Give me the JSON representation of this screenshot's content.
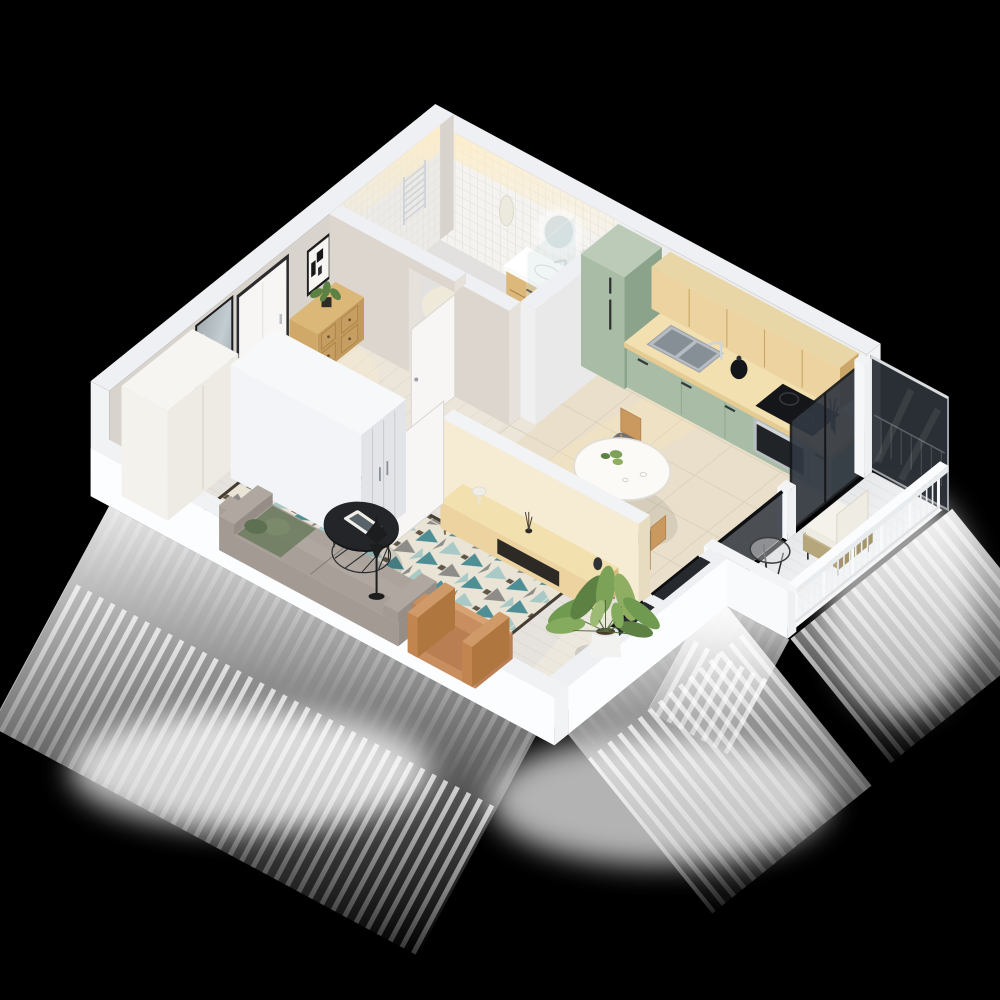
{
  "scene": {
    "description": "3D isometric cutaway floor-plan render of a studio apartment on a black background",
    "view": "top-down axonometric, no ceiling, exterior light-glow under the cut walls",
    "background": "#000000"
  },
  "palette": {
    "background": "#000000",
    "wallTop": "#eef0f3",
    "wallInnerWhite": "#ececea",
    "wallGreige": "#d8d3cc",
    "wallCream": "#f6ecd3",
    "wallCreamShade": "#e8dcc0",
    "wallOuterBright": "#fcfdfe",
    "floorWood": "#e6e3de",
    "floorHall": "#ebe5da",
    "floorKitchen": "#eadfcb",
    "floorBath": "#e2e1df",
    "tileWhite": "#f4f3f0",
    "tileLine": "#e2e0da",
    "cabinetGreen": "#a9bda6",
    "cabinetGreenDark": "#8ba38a",
    "woodLight": "#ecd3a0",
    "woodMid": "#d9ba7e",
    "counterTop": "#f2e0b0",
    "steel": "#b9bec2",
    "chrome": "#cfd4d9",
    "dark": "#1c1d1f",
    "glassDark": "#2d3239",
    "sofaGrey": "#a39b93",
    "pillowGreen": "#7a8a6a",
    "pillowGreenDark": "#5e7052",
    "rugTeal": "#4e8e95",
    "rugTealLight": "#a9c9c6",
    "rugGrey": "#8d8c88",
    "rugCream": "#e9e4d6",
    "rugDark": "#463c30",
    "armchairTan": "#c98e60",
    "plantGreen": "#7ca257",
    "plantGreenDark": "#5d8043",
    "plantGreenLight": "#8fae62",
    "doorWhite": "#f7f6f4",
    "frameDark": "#2b2b2d",
    "rattan": "#b6a67c",
    "cushionWhite": "#eeebe2",
    "glow": "#ffffff",
    "warmLight": "#ffedc4"
  },
  "rooms": [
    {
      "id": "bathroom",
      "items": [
        "towel-radiator",
        "toilet",
        "toilet-paper-holder",
        "bathrobe",
        "led-mirror",
        "vanity-sink",
        "shower-glass",
        "shower-set"
      ]
    },
    {
      "id": "hallway",
      "items": [
        "entrance-door",
        "abstract-artwork",
        "wall-mirror",
        "shoe-dresser",
        "small-plant",
        "hall-closet",
        "wardrobe",
        "bathroom-door",
        "interior-door"
      ]
    },
    {
      "id": "kitchen",
      "items": [
        "tall-fridge-cabinet",
        "green-base-cabinets",
        "wood-upper-cabinets",
        "countertop",
        "sink",
        "faucet",
        "kettle",
        "induction-hob",
        "oven",
        "utensil-crock",
        "tile-backsplash"
      ]
    },
    {
      "id": "dining",
      "items": [
        "white-table",
        "wood-chairs",
        "table-plant",
        "glassware"
      ]
    },
    {
      "id": "living-room",
      "items": [
        "geometric-rug",
        "grey-sofa",
        "green-pillows",
        "round-coffee-table",
        "magazines",
        "floor-lamp",
        "media-console",
        "mushroom-lamp",
        "reed-diffuser",
        "dark-vase",
        "partition-wall",
        "tan-armchair",
        "large-potted-plant"
      ]
    },
    {
      "id": "balcony",
      "items": [
        "tall-glass-panel",
        "glass-door",
        "low-glass-guard",
        "white-railing",
        "rattan-chair",
        "white-cushions",
        "round-side-table"
      ]
    }
  ]
}
